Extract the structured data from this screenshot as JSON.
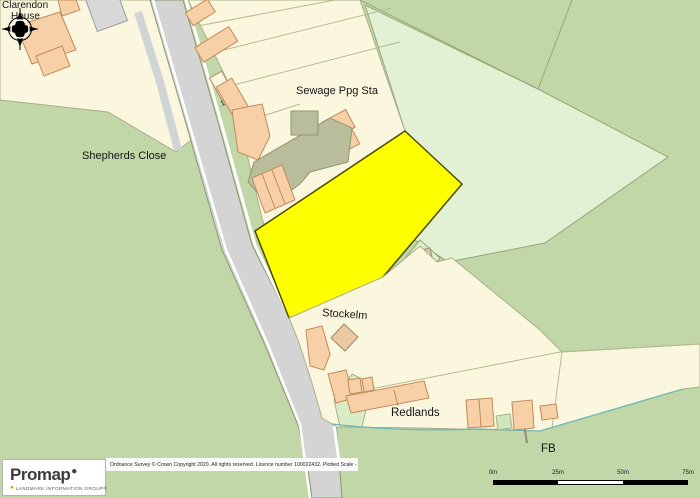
{
  "map": {
    "labels": {
      "clarendon_line1": "Clarendon",
      "clarendon_line2": "House",
      "sewage": "Sewage Ppg Sta",
      "shepherds_close": "Shepherds Close",
      "stockelm": "Stockelm",
      "redlands": "Redlands",
      "fb": "FB",
      "house_number": "1"
    },
    "colors": {
      "background_green": "#c2d7a8",
      "light_field_green": "#e2f1d3",
      "parcel_cream": "#fbf7de",
      "road_grey": "#d4d4d4",
      "building_peach": "#f7d0a8",
      "building_tan": "#d8cba6",
      "works_khaki": "#b9bd9b",
      "plot_highlight_yellow": "#ffff00",
      "stream_teal": "#6fb8b8"
    }
  },
  "footer": {
    "logo": {
      "brand": "Promap",
      "tagline": "LANDMARK INFORMATION GROUP®"
    },
    "copyright_prefix": "Ordnance Survey © Crown Copyright 2020. All rights reserved. Licence number 100022432. Plotted Scale -",
    "plotted_scale": "1:1250",
    "scale_bar": {
      "ticks": [
        "0m",
        "25m",
        "50m",
        "75m"
      ]
    }
  }
}
